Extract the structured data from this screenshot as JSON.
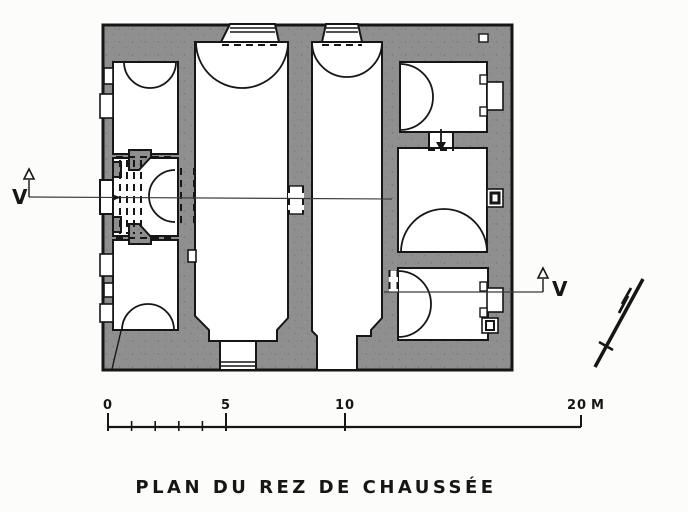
{
  "title": "PLAN DU REZ DE CHAUSSÉE",
  "section_markers": {
    "left_label": "V",
    "right_label": "V"
  },
  "scale_bar": {
    "tick_0": "0",
    "tick_5": "5",
    "tick_10": "10",
    "tick_20": "20",
    "unit_label": "M"
  },
  "icons": {
    "north": "north-arrow-icon",
    "section_left": "section-arrow-up-icon",
    "section_right": "section-arrow-up-icon"
  },
  "colors": {
    "wall_fill": "#8f8f8f",
    "ink": "#161616",
    "paper": "#fcfcfa"
  }
}
